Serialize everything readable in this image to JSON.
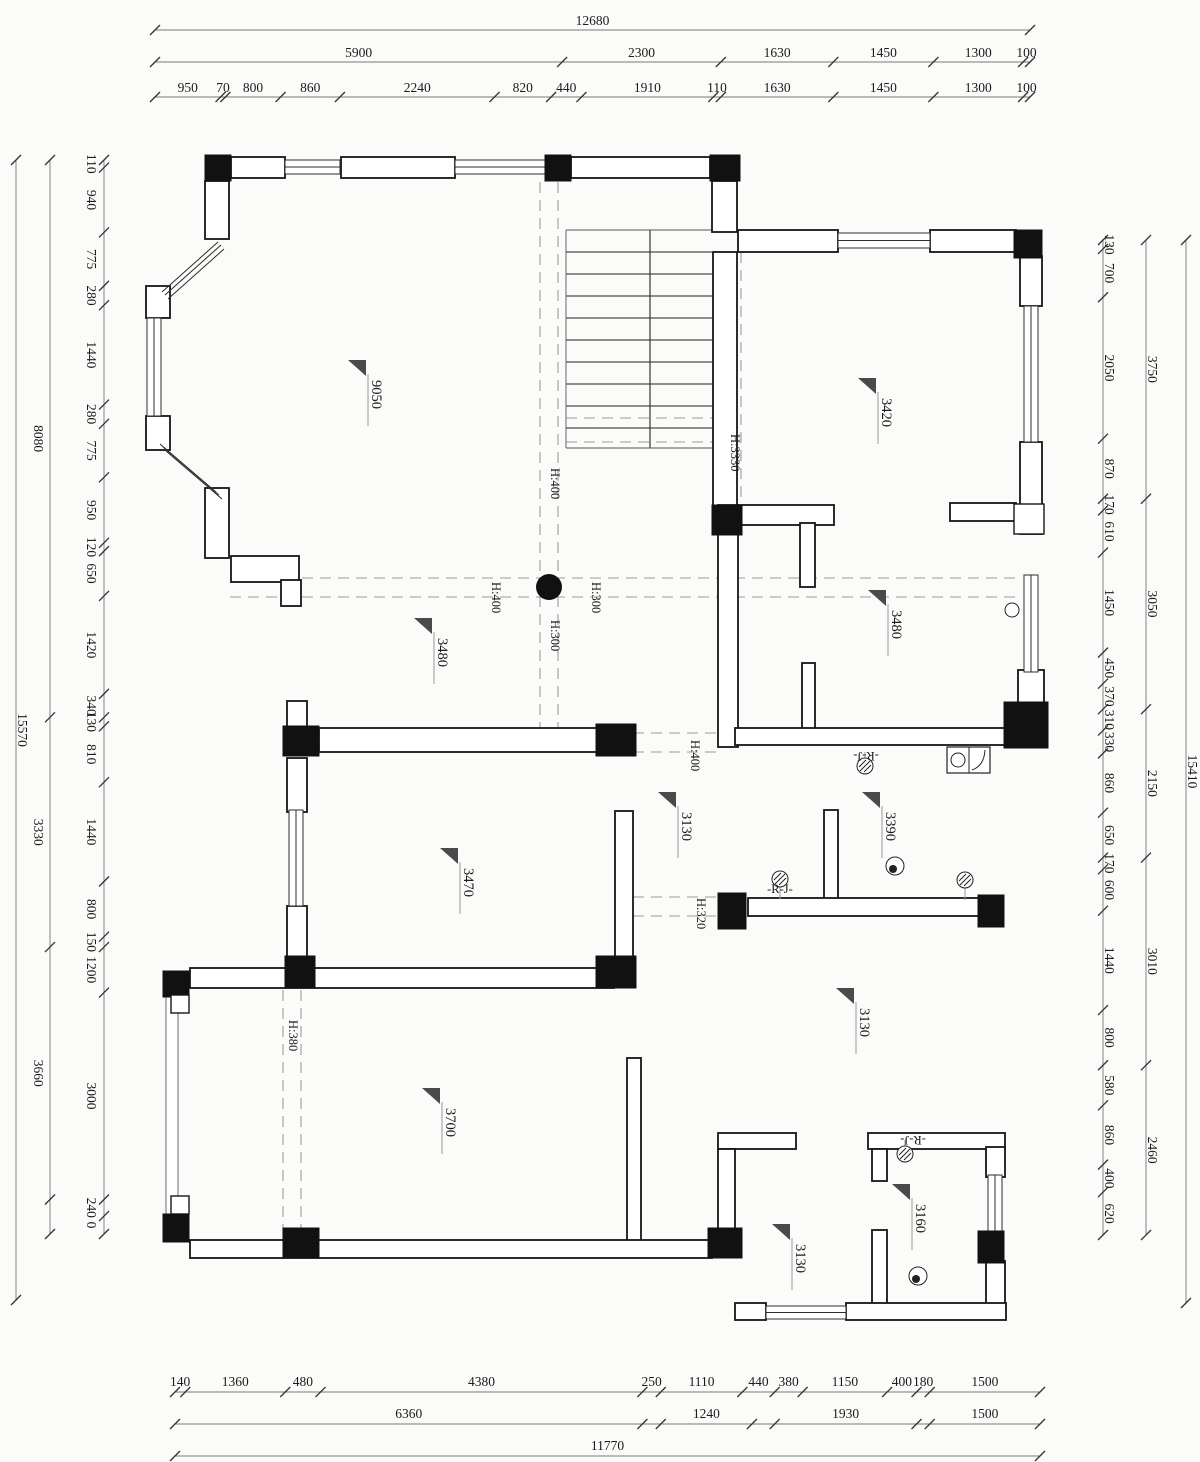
{
  "meta": {
    "drawing_type": "architectural floor plan with dimension chains"
  },
  "palette": {
    "wall": "#161616",
    "dash": "#9b9b9b",
    "dim_text": "#1b1b1b",
    "triangle": "#4a4a4a",
    "paper": "#fbfbfa"
  },
  "dims": {
    "strips": [
      {
        "id": "top-total",
        "orient": "h",
        "line": 30,
        "from": 155,
        "to": 1030,
        "toff": -5,
        "segs": [
          [
            12680,
            "12680"
          ]
        ]
      },
      {
        "id": "top-major",
        "orient": "h",
        "line": 62,
        "from": 155,
        "to": 1030,
        "toff": -5,
        "segs": [
          [
            5900,
            "5900"
          ],
          [
            2300,
            "2300"
          ],
          [
            1630,
            "1630"
          ],
          [
            1450,
            "1450"
          ],
          [
            1300,
            "1300"
          ],
          [
            100,
            "100"
          ]
        ]
      },
      {
        "id": "top-minor",
        "orient": "h",
        "line": 97,
        "from": 155,
        "to": 1030,
        "toff": -5,
        "segs": [
          [
            950,
            "950"
          ],
          [
            70,
            "70"
          ],
          [
            800,
            "800"
          ],
          [
            860,
            "860"
          ],
          [
            2240,
            "2240"
          ],
          [
            820,
            "820"
          ],
          [
            440,
            "440"
          ],
          [
            1910,
            "1910"
          ],
          [
            110,
            "110"
          ],
          [
            1630,
            "1630"
          ],
          [
            1450,
            "1450"
          ],
          [
            1300,
            "1300"
          ],
          [
            100,
            "100"
          ]
        ]
      },
      {
        "id": "bottom-minor",
        "orient": "h",
        "line": 1392,
        "from": 175,
        "to": 1040,
        "toff": -6,
        "segs": [
          [
            140,
            "140"
          ],
          [
            1360,
            "1360"
          ],
          [
            480,
            "480"
          ],
          [
            4380,
            "4380"
          ],
          [
            250,
            "250"
          ],
          [
            1110,
            "1110"
          ],
          [
            440,
            "440"
          ],
          [
            380,
            "380"
          ],
          [
            1150,
            "1150"
          ],
          [
            400,
            "400"
          ],
          [
            180,
            "180"
          ],
          [
            1500,
            "1500"
          ]
        ]
      },
      {
        "id": "bottom-major",
        "orient": "h",
        "line": 1424,
        "from": 175,
        "to": 1040,
        "toff": -6,
        "segs": [
          [
            6360,
            "6360"
          ],
          [
            250,
            ""
          ],
          [
            1240,
            "1240"
          ],
          [
            310,
            ""
          ],
          [
            1930,
            "1930"
          ],
          [
            180,
            ""
          ],
          [
            1500,
            "1500"
          ]
        ]
      },
      {
        "id": "bottom-total",
        "orient": "h",
        "line": 1456,
        "from": 175,
        "to": 1040,
        "toff": -6,
        "segs": [
          [
            11770,
            "11770"
          ]
        ]
      },
      {
        "id": "left-minor",
        "orient": "v",
        "line": 104,
        "from": 160,
        "to": 1234,
        "toff": -17,
        "segs": [
          [
            110,
            "110"
          ],
          [
            940,
            "940"
          ],
          [
            775,
            "775"
          ],
          [
            280,
            "280"
          ],
          [
            1440,
            "1440"
          ],
          [
            280,
            "280"
          ],
          [
            775,
            "775"
          ],
          [
            950,
            "950"
          ],
          [
            120,
            "120"
          ],
          [
            650,
            "650"
          ],
          [
            1420,
            "1420"
          ],
          [
            340,
            "340"
          ],
          [
            130,
            "130"
          ],
          [
            810,
            "810"
          ],
          [
            1440,
            "1440"
          ],
          [
            800,
            "800"
          ],
          [
            150,
            "150"
          ],
          [
            660,
            "1200"
          ],
          [
            3000,
            "3000"
          ],
          [
            240,
            "240"
          ],
          [
            260,
            "0"
          ]
        ]
      },
      {
        "id": "left-major",
        "orient": "v",
        "line": 50,
        "from": 160,
        "to": 1234,
        "toff": -16,
        "segs": [
          [
            8080,
            "8080"
          ],
          [
            3330,
            "3330"
          ],
          [
            3660,
            "3660"
          ],
          [
            500,
            ""
          ]
        ]
      },
      {
        "id": "left-total",
        "orient": "v",
        "line": 16,
        "from": 160,
        "to": 1300,
        "toff": 2,
        "segs": [
          [
            15570,
            "15570"
          ]
        ]
      },
      {
        "id": "right-minor",
        "orient": "v",
        "line": 1103,
        "from": 240,
        "to": 1235,
        "toff": 2,
        "segs": [
          [
            130,
            "130"
          ],
          [
            700,
            "700"
          ],
          [
            2050,
            "2050"
          ],
          [
            870,
            "870"
          ],
          [
            170,
            "170"
          ],
          [
            610,
            "610"
          ],
          [
            1450,
            "1450"
          ],
          [
            450,
            "450"
          ],
          [
            370,
            "370"
          ],
          [
            310,
            "310"
          ],
          [
            330,
            "330"
          ],
          [
            860,
            "860"
          ],
          [
            650,
            "650"
          ],
          [
            170,
            "170"
          ],
          [
            600,
            "600"
          ],
          [
            1440,
            "1440"
          ],
          [
            800,
            "800"
          ],
          [
            580,
            "580"
          ],
          [
            860,
            "860"
          ],
          [
            400,
            "400"
          ],
          [
            620,
            "620"
          ]
        ]
      },
      {
        "id": "right-major",
        "orient": "v",
        "line": 1146,
        "from": 240,
        "to": 1235,
        "toff": 2,
        "segs": [
          [
            3750,
            "3750"
          ],
          [
            3050,
            "3050"
          ],
          [
            2150,
            "2150"
          ],
          [
            3010,
            "3010"
          ],
          [
            2460,
            "2460"
          ]
        ]
      },
      {
        "id": "right-total",
        "orient": "v",
        "line": 1186,
        "from": 240,
        "to": 1303,
        "toff": 2,
        "segs": [
          [
            15410,
            "15410"
          ]
        ]
      }
    ]
  },
  "labels": {
    "rooms": [
      [
        "9050",
        372,
        380
      ],
      [
        "3420",
        882,
        398
      ],
      [
        "3480",
        892,
        610
      ],
      [
        "3480",
        438,
        638
      ],
      [
        "3470",
        464,
        868
      ],
      [
        "3130",
        682,
        812
      ],
      [
        "3390",
        886,
        812
      ],
      [
        "3130",
        860,
        1008
      ],
      [
        "3700",
        446,
        1108
      ],
      [
        "3130",
        796,
        1244
      ],
      [
        "3160",
        916,
        1204
      ]
    ],
    "heights": [
      [
        "H:400",
        551,
        468
      ],
      [
        "H:3330",
        731,
        434
      ],
      [
        "H:400",
        492,
        582
      ],
      [
        "H:300",
        592,
        582
      ],
      [
        "H:300",
        551,
        620
      ],
      [
        "H:400",
        691,
        740
      ],
      [
        "H:320",
        697,
        898
      ],
      [
        "H:380",
        289,
        1020
      ]
    ],
    "pipes": [
      [
        "-R-J-",
        780,
        893,
        0
      ],
      [
        "-R-J-",
        866,
        752,
        180
      ],
      [
        "-R-J-",
        913,
        1136,
        180
      ]
    ]
  }
}
